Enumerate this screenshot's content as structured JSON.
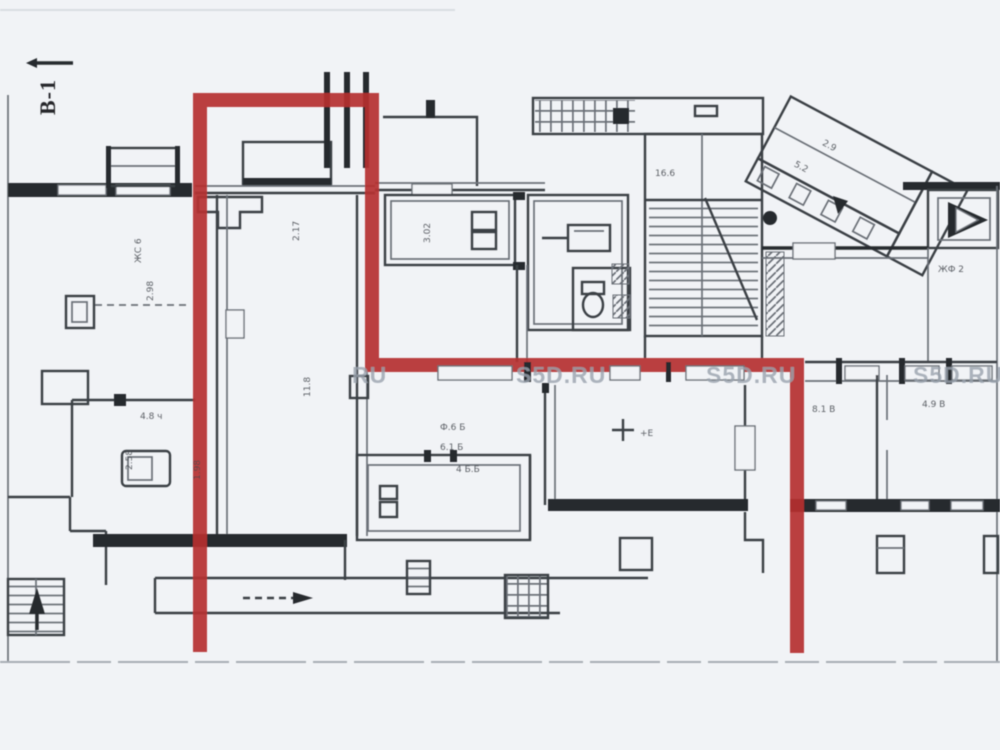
{
  "page": {
    "background": "#f1f3f6"
  },
  "plan": {
    "section_label": "В-1",
    "watermarks": [
      {
        "text": "RU"
      },
      {
        "text": "S5D.RU"
      },
      {
        "text": "S5D.RU"
      },
      {
        "text": "S5D.RU"
      }
    ],
    "annotations": [
      {
        "text": "2.17"
      },
      {
        "text": "11.8"
      },
      {
        "text": "ЖС 6"
      },
      {
        "text": "2.98"
      },
      {
        "text": "4.8 ч"
      },
      {
        "text": "2.58"
      },
      {
        "text": "3.02"
      },
      {
        "text": "Ф.6 Б"
      },
      {
        "text": "6.1 Б"
      },
      {
        "text": "4 Б.Б"
      },
      {
        "text": "+Е"
      },
      {
        "text": "ЖФ 2"
      },
      {
        "text": "16.6"
      },
      {
        "text": "8.1 В"
      },
      {
        "text": "4.9 В"
      },
      {
        "text": "2.9"
      },
      {
        "text": "5.2"
      },
      {
        "text": "1.98"
      }
    ],
    "colors": {
      "red": "#b5302f",
      "bg": "#f1f3f6",
      "wall": "#3b3f45",
      "wall-dark": "#26292d",
      "wall-light": "#6b7077",
      "wmk": "#9aa3ae"
    }
  }
}
